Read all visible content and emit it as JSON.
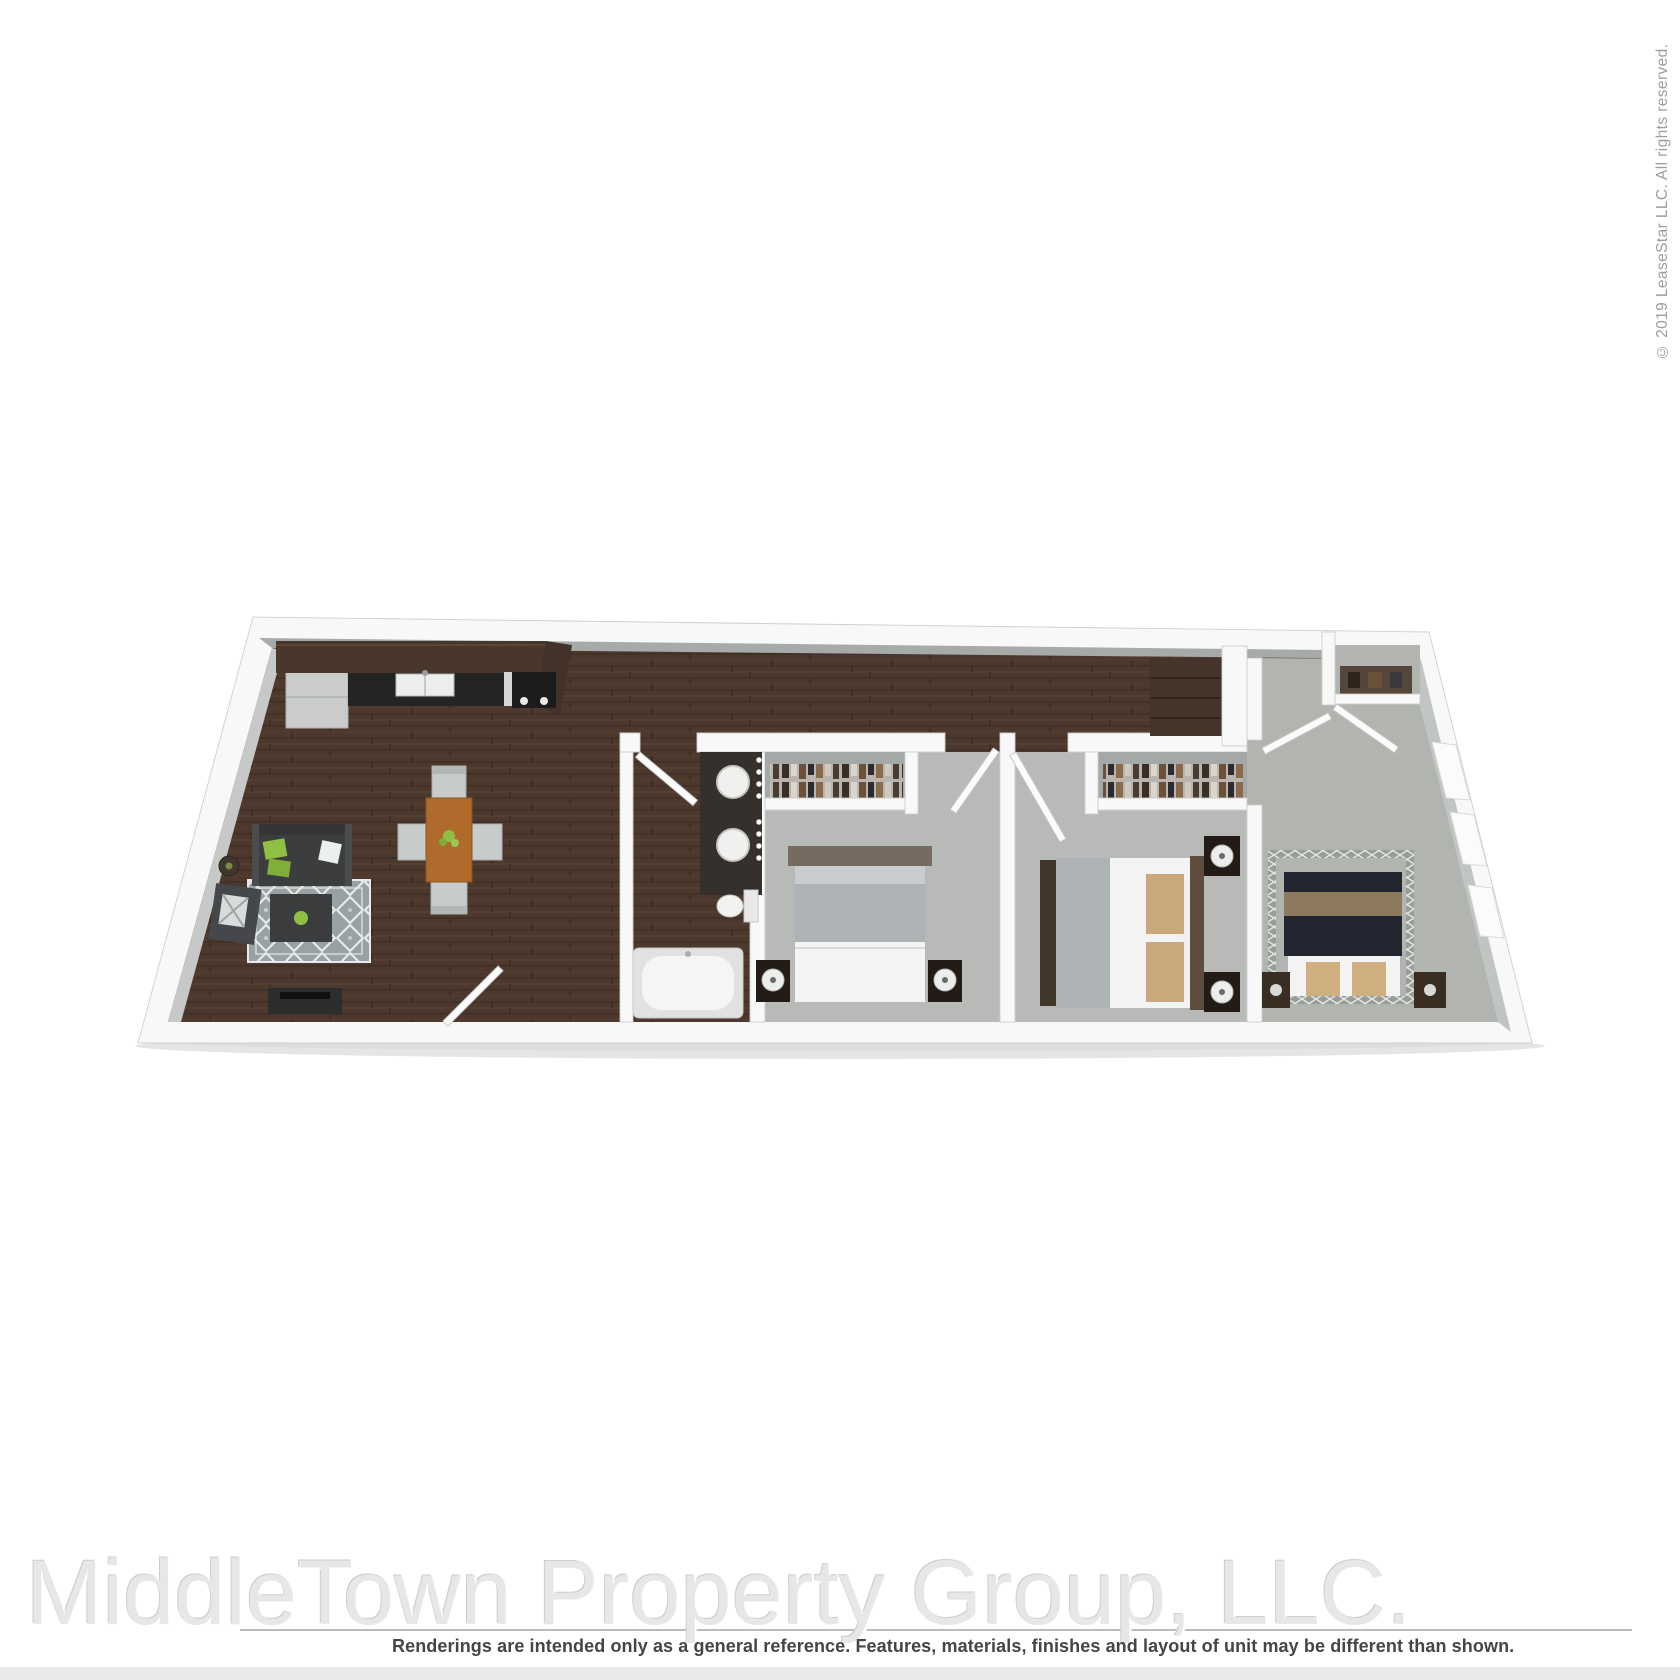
{
  "watermark": {
    "text": "MiddleTown Property Group, LLC."
  },
  "disclaimer": {
    "text": "Renderings are intended only as a general reference. Features, materials, finishes and layout of unit may be different than shown."
  },
  "copyright": {
    "text": "© 2019 LeaseStar LLC. All rights reserved."
  },
  "floor_plan": {
    "type": "3d-rendered-floor-plan",
    "description": "Top-down 3D rendering of a 3-bedroom, 1-bathroom apartment drawn in perspective (trapezoid footprint), dark hardwood in kitchen/living/hall/bath, gray carpet in bedrooms.",
    "rooms": [
      {
        "name": "Kitchen",
        "floor": "dark hardwood",
        "furniture": [
          "refrigerator",
          "wood bar counter",
          "black counter with double-basin sink",
          "range with burner knobs"
        ]
      },
      {
        "name": "Living / Dining Area",
        "floor": "dark hardwood",
        "furniture": [
          "charcoal sofa with green accent pillows",
          "gray trellis-pattern area rug",
          "dark ottoman coffee table with green accent",
          "armchair with patterned pillow",
          "round side table",
          "TV media console",
          "wood dining table with green centerpiece",
          "4 gray dining chairs",
          "entry door"
        ]
      },
      {
        "name": "Bathroom",
        "floor": "dark hardwood",
        "furniture": [
          "dark double vanity with two round sinks",
          "vanity light bulbs",
          "toilet",
          "garden tub",
          "door"
        ]
      },
      {
        "name": "Bedroom 1",
        "floor": "gray carpet",
        "furniture": [
          "closet with hanging clothes",
          "bed with gray blanket and white duvet",
          "2 dark nightstands with round lamps",
          "door"
        ]
      },
      {
        "name": "Bedroom 2",
        "floor": "gray carpet",
        "furniture": [
          "closet with hanging clothes",
          "bed with white duvet and tan pillows",
          "footboard bench",
          "2 dark nightstands with round lamps",
          "door"
        ]
      },
      {
        "name": "Bedroom 3",
        "floor": "gray carpet",
        "furniture": [
          "canopy bed with lattice frame and navy bedding",
          "tan accent pillows",
          "2 nightstands",
          "closet with shelf",
          "3 windows on angled wall",
          "hall wardrobe",
          "door"
        ]
      }
    ],
    "palette": {
      "wall": "#f7f8f7",
      "wall-stroke": "#ccd0cf",
      "inner-face": "#a6abaa",
      "wood": "#4c382c",
      "wood-line": "#382a20",
      "carpet": "#b8bab7",
      "concrete": "#b2b4b0",
      "bar-wood": "#4a372c",
      "counter-black": "#242424",
      "appliance-gray": "#c9cccb",
      "sofa-dark": "#3b3d3f",
      "rug-base": "#98a2a2",
      "rug-line": "#e7eae8",
      "accent-green": "#8fc044",
      "dining-wood": "#b06a2c",
      "chair-gray": "#c7cbca",
      "bedding-white": "#f2f3f2",
      "bedding-gray": "#adb2b4",
      "pillow-tan": "#c9a87c",
      "bed3-dark": "#232630",
      "bed3-band": "#8d7a5e",
      "nightstand-dark": "#231c16",
      "lattice-gray": "#999d99",
      "watermark-gray": "#e7e7e7",
      "disclaimer-gray": "#454545",
      "copyright-gray": "#9d9da0",
      "divider-gray": "#b9bcbb",
      "footer-band-gray": "#e9ebeb"
    }
  }
}
